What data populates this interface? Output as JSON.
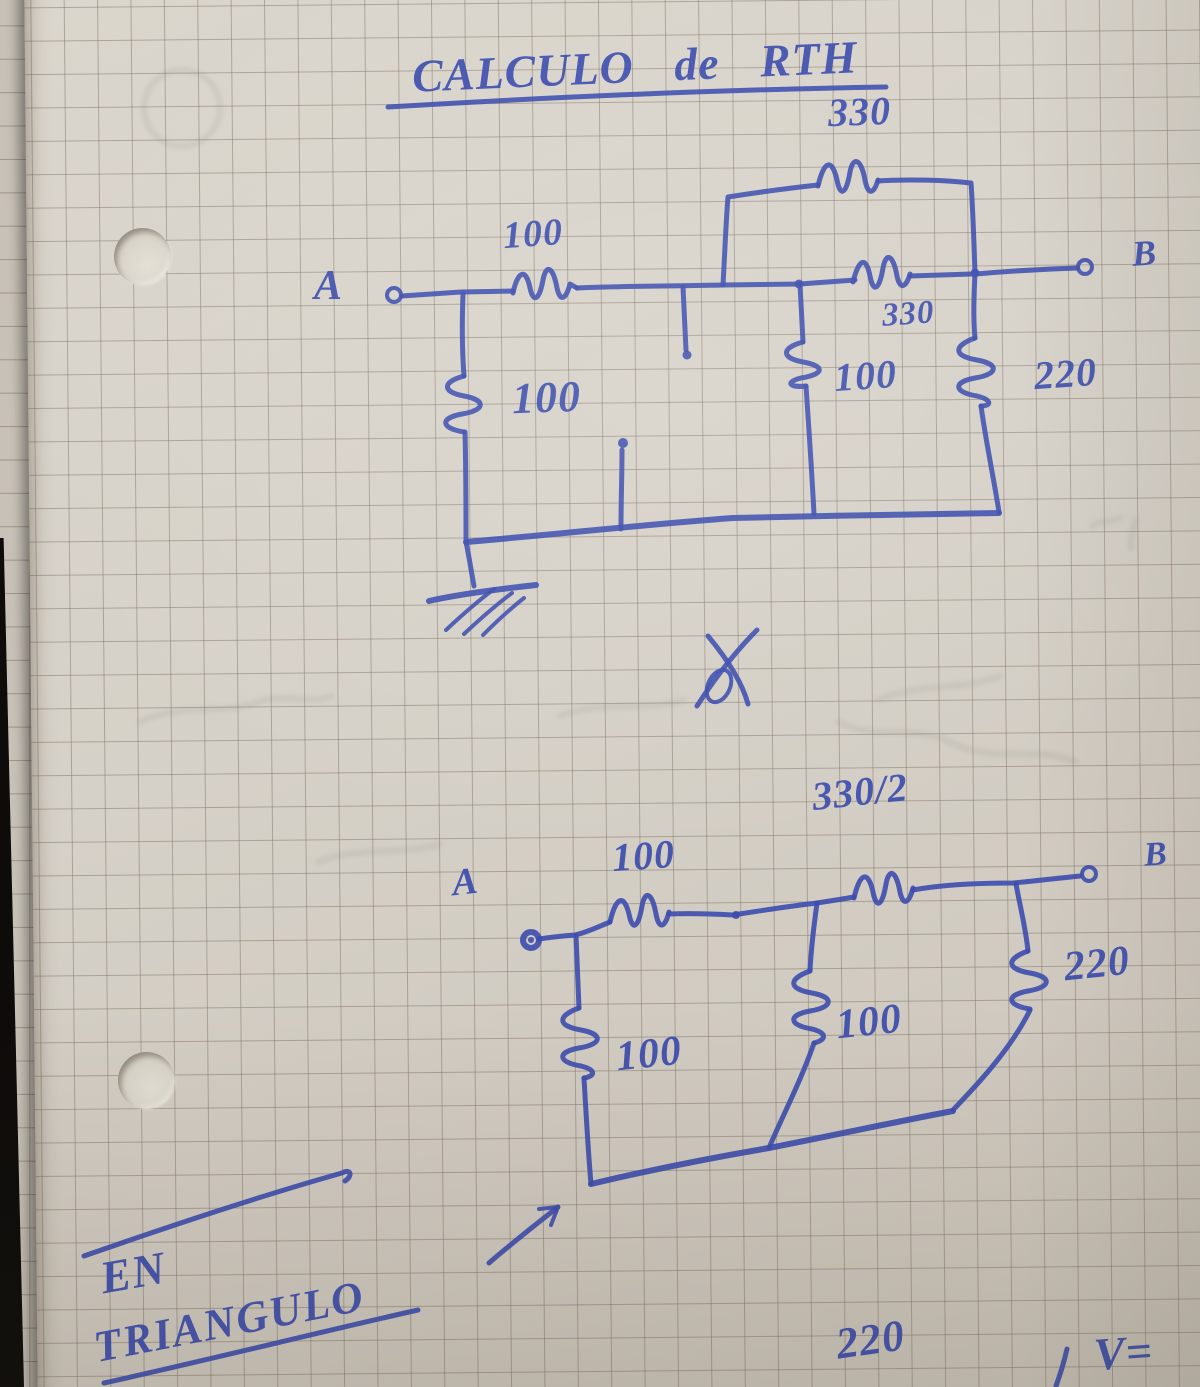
{
  "colors": {
    "ink": "#3c4dae",
    "paper": "#d6d1c8"
  },
  "title": {
    "text": "CALCULO de RTH"
  },
  "circuit_top": {
    "node_a": "A",
    "node_b": "B",
    "r_parallel_top": "330",
    "r_series_input": "100",
    "r_shunt_input": "100",
    "r_series_mid": "330",
    "r_shunt_mid": "100",
    "r_shunt_output": "220"
  },
  "circuit_bottom": {
    "node_a": "A",
    "node_b": "B",
    "r_series_input": "100",
    "r_series_output": "330/2",
    "r_shunt_input": "100",
    "r_shunt_mid": "100",
    "r_shunt_output": "220"
  },
  "notes": {
    "bottom_left_line1": "EN",
    "bottom_left_line2": "TRIANGULO",
    "bottom_right_value": "220",
    "bottom_right_formula": "V="
  }
}
